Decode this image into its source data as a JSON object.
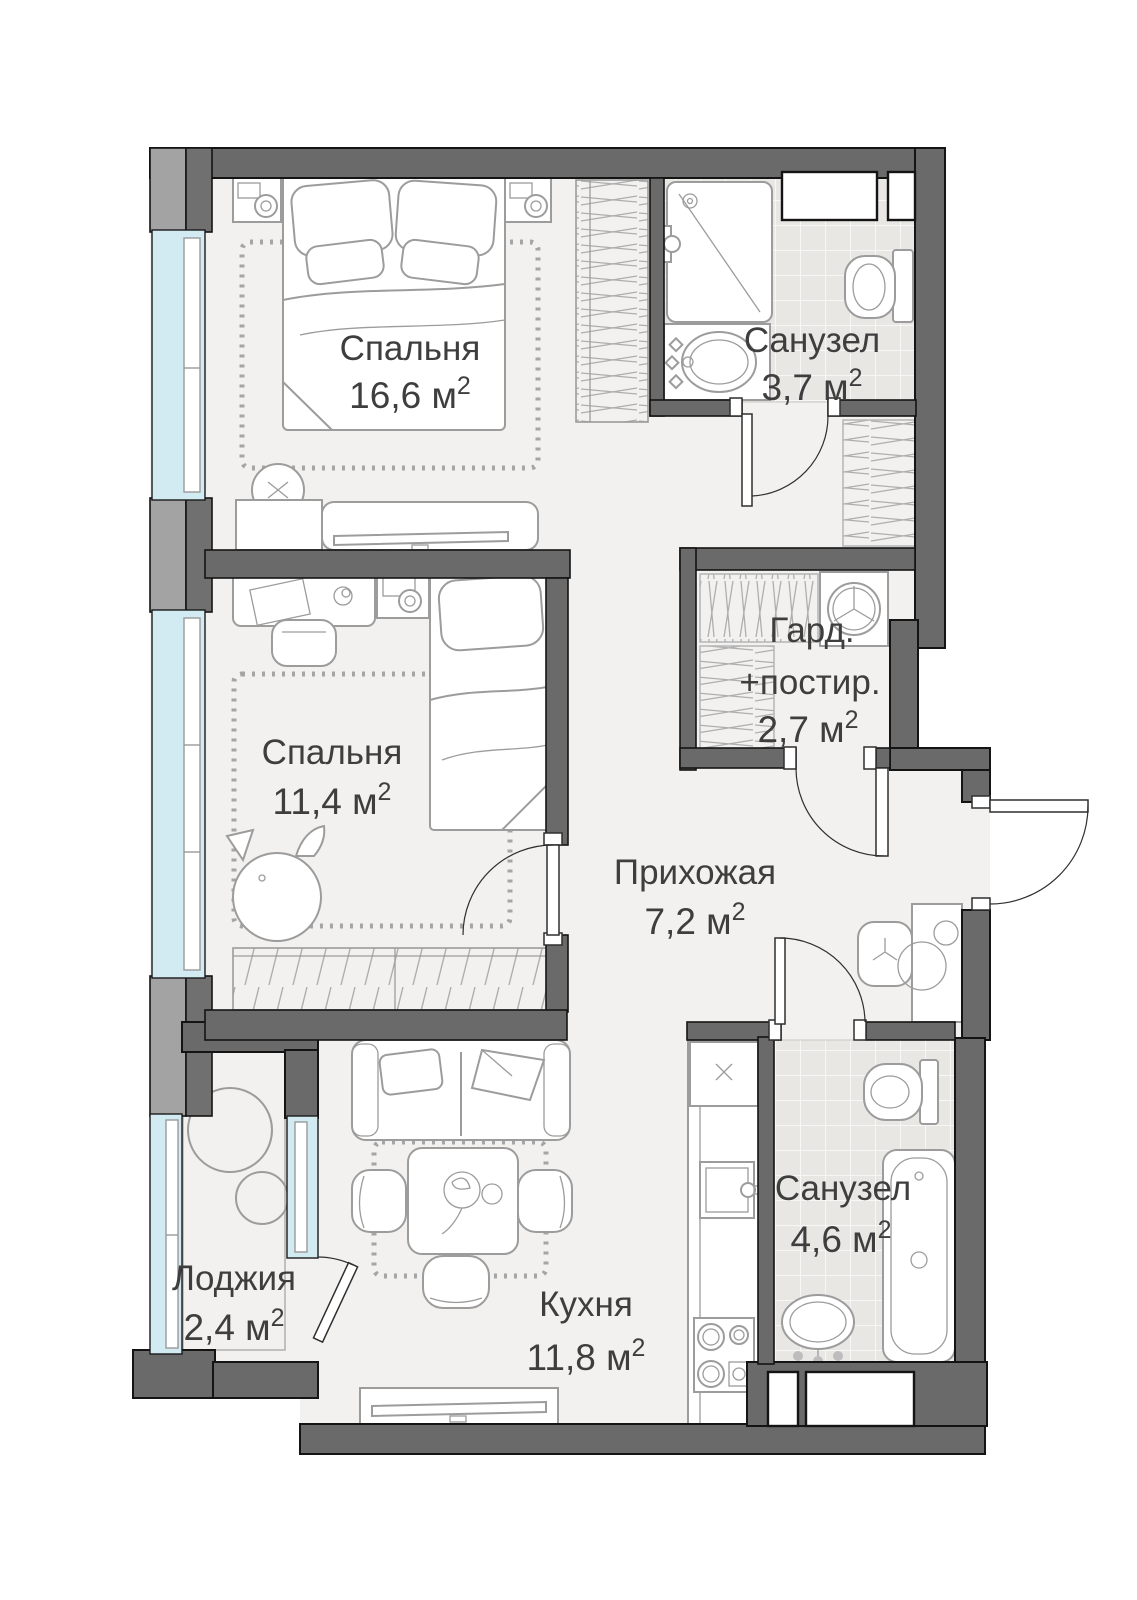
{
  "colors": {
    "wall": "#6a6a6a",
    "outline": "#141414",
    "floor": "#f2f1ef",
    "glass": "#d2eaf2",
    "furn": "#9c9c9c",
    "text": "#3e3e3e",
    "tile": "#e9e7e4"
  },
  "rooms": {
    "bedroom1": {
      "name": "Спальня",
      "area": "16,6 м",
      "sup": "2"
    },
    "bathroom1": {
      "name": "Санузел",
      "area": "3,7 м",
      "sup": "2"
    },
    "bedroom2": {
      "name": "Спальня",
      "area": "11,4 м",
      "sup": "2"
    },
    "wardrobe_laundry": {
      "name1": "Гард.",
      "name2": "+постир.",
      "area": "2,7 м",
      "sup": "2"
    },
    "hallway": {
      "name": "Прихожая",
      "area": "7,2 м",
      "sup": "2"
    },
    "bathroom2": {
      "name": "Санузел",
      "area": "4,6 м",
      "sup": "2"
    },
    "kitchen": {
      "name": "Кухня",
      "area": "11,8 м",
      "sup": "2"
    },
    "loggia": {
      "name": "Лоджия",
      "area": "2,4 м",
      "sup": "2"
    }
  }
}
